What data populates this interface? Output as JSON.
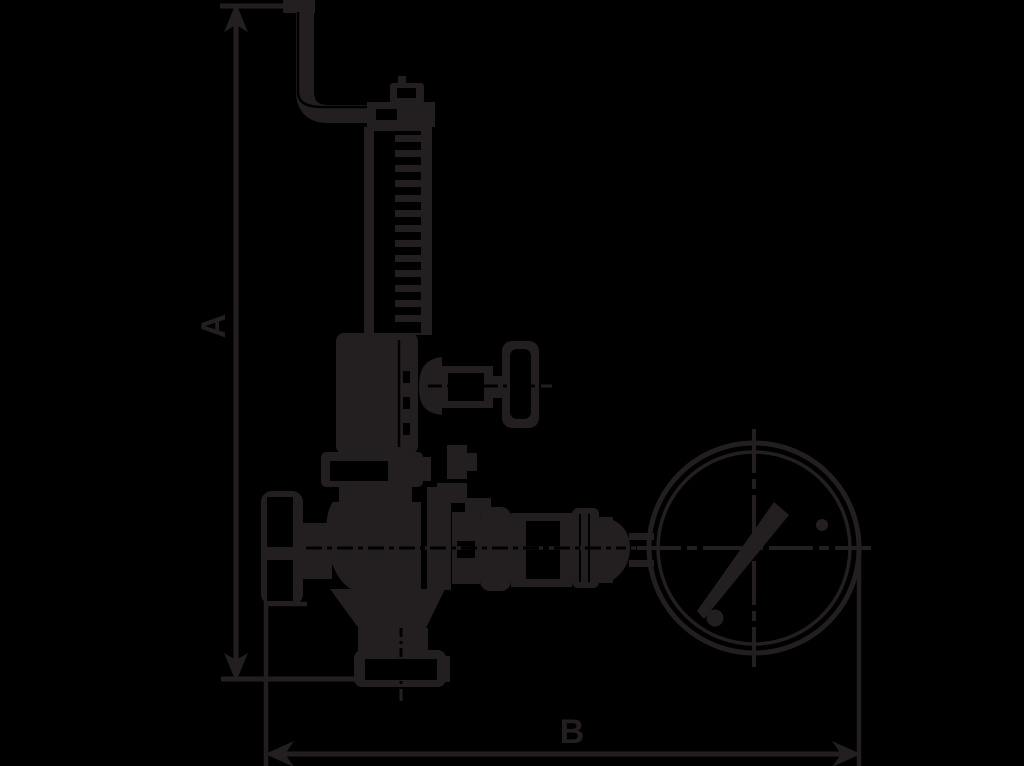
{
  "canvas": {
    "width": 1024,
    "height": 766,
    "background": "#000000",
    "ink": "#231f20"
  },
  "labels": {
    "dimension_vertical": "A",
    "dimension_horizontal": "B"
  },
  "parts": [
    "lever-arm",
    "spring-housing",
    "bonnet",
    "test-valve-knob",
    "handwheel",
    "valve-body",
    "outlet-flange",
    "gauge-connection-pipe",
    "pressure-gauge"
  ]
}
